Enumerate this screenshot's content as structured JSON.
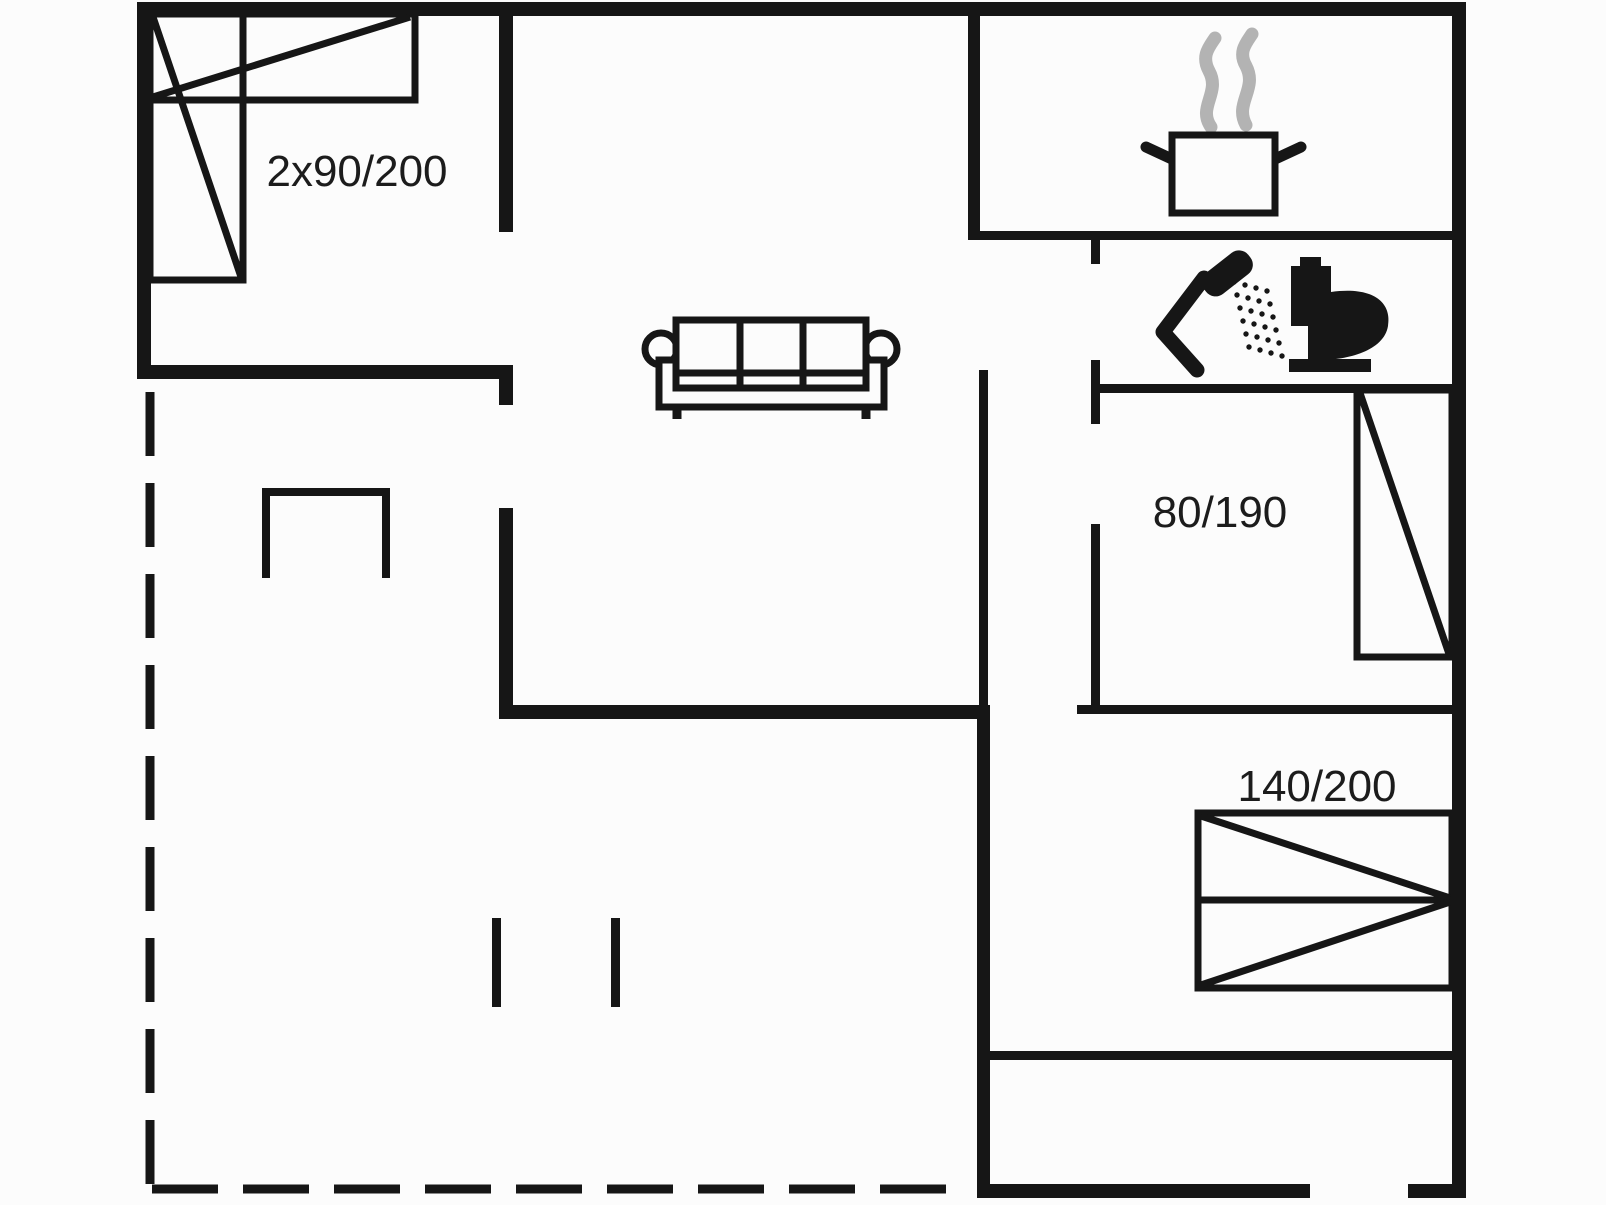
{
  "floorplan": {
    "canvas": {
      "width": 1606,
      "height": 1205,
      "colors": {
        "bg": "#fcfcfc",
        "ink": "#161616",
        "steam": "#b3b3b3",
        "label": "#1c1c1c"
      }
    },
    "labels": [
      {
        "id": "double-bed-size",
        "text": "2x90/200"
      },
      {
        "id": "single-bed-size",
        "text": "80/190"
      },
      {
        "id": "queen-bed-size",
        "text": "140/200"
      }
    ],
    "figures": [
      {
        "name": "terrace-dashed-line-left",
        "tag": "line",
        "attrs": {
          "x1": 150,
          "y1": 392,
          "x2": 150,
          "y2": 1190,
          "stroke": "ink",
          "stroke-width": 9,
          "stroke-dasharray": "64 27"
        }
      },
      {
        "name": "terrace-dashed-line-bottom",
        "tag": "line",
        "attrs": {
          "x1": 152,
          "y1": 1189,
          "x2": 963,
          "y2": 1189,
          "stroke": "ink",
          "stroke-width": 9,
          "stroke-dasharray": "66 25"
        }
      },
      {
        "name": "wall-kitchen-bath-divider",
        "tag": "rect",
        "attrs": {
          "x": 968,
          "y": 231,
          "width": 484,
          "height": 9,
          "fill": "ink"
        }
      },
      {
        "name": "wall-bath-left-stub",
        "tag": "rect",
        "attrs": {
          "x": 1091,
          "y": 240,
          "width": 9,
          "height": 24,
          "fill": "ink"
        }
      },
      {
        "name": "wall-bath-left",
        "tag": "rect",
        "attrs": {
          "x": 1091,
          "y": 360,
          "width": 9,
          "height": 64,
          "fill": "ink"
        }
      },
      {
        "name": "wall-bath-bottom",
        "tag": "rect",
        "attrs": {
          "x": 1091,
          "y": 384,
          "width": 361,
          "height": 9,
          "fill": "ink"
        }
      },
      {
        "name": "wall-bedroom2-left",
        "tag": "rect",
        "attrs": {
          "x": 1091,
          "y": 524,
          "width": 9,
          "height": 188,
          "fill": "ink"
        }
      },
      {
        "name": "wall-bedroom2-bottom",
        "tag": "rect",
        "attrs": {
          "x": 1077,
          "y": 705,
          "width": 375,
          "height": 9,
          "fill": "ink"
        }
      },
      {
        "name": "wall-center-thin",
        "tag": "rect",
        "attrs": {
          "x": 979,
          "y": 370,
          "width": 9,
          "height": 342,
          "fill": "ink"
        }
      },
      {
        "name": "wall-bedroom3-bottom",
        "tag": "rect",
        "attrs": {
          "x": 990,
          "y": 1051,
          "width": 462,
          "height": 9,
          "fill": "ink"
        }
      },
      {
        "name": "wall-stub-hall-a",
        "tag": "rect",
        "attrs": {
          "x": 492,
          "y": 918,
          "width": 9,
          "height": 89,
          "fill": "ink"
        }
      },
      {
        "name": "wall-stub-hall-b",
        "tag": "rect",
        "attrs": {
          "x": 611,
          "y": 918,
          "width": 9,
          "height": 89,
          "fill": "ink"
        }
      },
      {
        "name": "wall-outer-top",
        "tag": "rect",
        "attrs": {
          "x": 137,
          "y": 2,
          "width": 1329,
          "height": 14,
          "fill": "ink"
        }
      },
      {
        "name": "wall-outer-left",
        "tag": "rect",
        "attrs": {
          "x": 137,
          "y": 2,
          "width": 14,
          "height": 377,
          "fill": "ink"
        }
      },
      {
        "name": "wall-outer-right",
        "tag": "rect",
        "attrs": {
          "x": 1452,
          "y": 2,
          "width": 14,
          "height": 1196,
          "fill": "ink"
        }
      },
      {
        "name": "wall-outer-bottom-west",
        "tag": "rect",
        "attrs": {
          "x": 977,
          "y": 1184,
          "width": 333,
          "height": 14,
          "fill": "ink"
        }
      },
      {
        "name": "wall-outer-bottom-east",
        "tag": "rect",
        "attrs": {
          "x": 1408,
          "y": 1184,
          "width": 58,
          "height": 14,
          "fill": "ink"
        }
      },
      {
        "name": "wall-bedroom1-bottom",
        "tag": "rect",
        "attrs": {
          "x": 137,
          "y": 365,
          "width": 376,
          "height": 14,
          "fill": "ink"
        }
      },
      {
        "name": "wall-bedroom1-bottom-stub",
        "tag": "rect",
        "attrs": {
          "x": 499,
          "y": 365,
          "width": 14,
          "height": 40,
          "fill": "ink"
        }
      },
      {
        "name": "wall-bedroom1-right",
        "tag": "rect",
        "attrs": {
          "x": 499,
          "y": 2,
          "width": 14,
          "height": 230,
          "fill": "ink"
        }
      },
      {
        "name": "wall-hall-left",
        "tag": "rect",
        "attrs": {
          "x": 499,
          "y": 508,
          "width": 14,
          "height": 211,
          "fill": "ink"
        }
      },
      {
        "name": "wall-living-bottom",
        "tag": "rect",
        "attrs": {
          "x": 499,
          "y": 705,
          "width": 491,
          "height": 14,
          "fill": "ink"
        }
      },
      {
        "name": "wall-center-lower",
        "tag": "rect",
        "attrs": {
          "x": 977,
          "y": 712,
          "width": 13,
          "height": 486,
          "fill": "ink"
        }
      },
      {
        "name": "wall-kitchen-left",
        "tag": "rect",
        "attrs": {
          "x": 968,
          "y": 10,
          "width": 12,
          "height": 230,
          "fill": "ink"
        }
      },
      {
        "name": "stove-nook-outline",
        "tag": "polyline",
        "attrs": {
          "points": "266,578 266,492 386,492 386,578",
          "fill": "none",
          "stroke": "ink",
          "stroke-width": 8
        }
      },
      {
        "name": "bed-double-rect-horizontal",
        "tag": "rect",
        "attrs": {
          "x": 150,
          "y": 14,
          "width": 265,
          "height": 86,
          "fill": "none",
          "stroke": "ink",
          "stroke-width": 7
        }
      },
      {
        "name": "bed-double-rect-vertical",
        "tag": "rect",
        "attrs": {
          "x": 150,
          "y": 14,
          "width": 93,
          "height": 266,
          "fill": "none",
          "stroke": "ink",
          "stroke-width": 7
        }
      },
      {
        "name": "bed-double-diagonal-h",
        "tag": "line",
        "attrs": {
          "x1": 153,
          "y1": 97,
          "x2": 410,
          "y2": 17,
          "stroke": "ink",
          "stroke-width": 7
        }
      },
      {
        "name": "bed-double-diagonal-v",
        "tag": "line",
        "attrs": {
          "x1": 153,
          "y1": 17,
          "x2": 241,
          "y2": 277,
          "stroke": "ink",
          "stroke-width": 7
        }
      },
      {
        "name": "bed-single-rect",
        "tag": "rect",
        "attrs": {
          "x": 1357,
          "y": 390,
          "width": 95,
          "height": 267,
          "fill": "none",
          "stroke": "ink",
          "stroke-width": 7
        }
      },
      {
        "name": "bed-single-diagonal",
        "tag": "line",
        "attrs": {
          "x1": 1360,
          "y1": 393,
          "x2": 1449,
          "y2": 654,
          "stroke": "ink",
          "stroke-width": 7
        }
      },
      {
        "name": "bed-queen-rect",
        "tag": "rect",
        "attrs": {
          "x": 1198,
          "y": 813,
          "width": 254,
          "height": 175,
          "fill": "none",
          "stroke": "ink",
          "stroke-width": 7
        }
      },
      {
        "name": "bed-queen-midline",
        "tag": "line",
        "attrs": {
          "x1": 1198,
          "y1": 900,
          "x2": 1452,
          "y2": 900,
          "stroke": "ink",
          "stroke-width": 7
        }
      },
      {
        "name": "bed-queen-diagonal-top",
        "tag": "line",
        "attrs": {
          "x1": 1201,
          "y1": 816,
          "x2": 1450,
          "y2": 898,
          "stroke": "ink",
          "stroke-width": 7
        }
      },
      {
        "name": "bed-queen-diagonal-bottom",
        "tag": "line",
        "attrs": {
          "x1": 1201,
          "y1": 985,
          "x2": 1450,
          "y2": 902,
          "stroke": "ink",
          "stroke-width": 7
        }
      },
      {
        "name": "sofa-arm-left",
        "tag": "circle",
        "attrs": {
          "cx": 661,
          "cy": 349,
          "r": 16,
          "fill": "bg",
          "stroke": "ink",
          "stroke-width": 7
        }
      },
      {
        "name": "sofa-arm-right",
        "tag": "circle",
        "attrs": {
          "cx": 881,
          "cy": 349,
          "r": 16,
          "fill": "bg",
          "stroke": "ink",
          "stroke-width": 7
        }
      },
      {
        "name": "sofa-base",
        "tag": "rect",
        "attrs": {
          "x": 659,
          "y": 360,
          "width": 225,
          "height": 47,
          "fill": "bg",
          "stroke": "ink",
          "stroke-width": 7
        }
      },
      {
        "name": "sofa-cushions",
        "tag": "rect",
        "attrs": {
          "x": 676,
          "y": 320,
          "width": 190,
          "height": 68,
          "fill": "bg",
          "stroke": "ink",
          "stroke-width": 7
        }
      },
      {
        "name": "sofa-divider-1",
        "tag": "line",
        "attrs": {
          "x1": 740,
          "y1": 320,
          "x2": 740,
          "y2": 388,
          "stroke": "ink",
          "stroke-width": 7
        }
      },
      {
        "name": "sofa-divider-2",
        "tag": "line",
        "attrs": {
          "x1": 803,
          "y1": 320,
          "x2": 803,
          "y2": 388,
          "stroke": "ink",
          "stroke-width": 7
        }
      },
      {
        "name": "sofa-seat-line",
        "tag": "line",
        "attrs": {
          "x1": 676,
          "y1": 373,
          "x2": 866,
          "y2": 373,
          "stroke": "ink",
          "stroke-width": 7
        }
      },
      {
        "name": "sofa-leg-left",
        "tag": "line",
        "attrs": {
          "x1": 677,
          "y1": 407,
          "x2": 677,
          "y2": 419,
          "stroke": "ink",
          "stroke-width": 9
        }
      },
      {
        "name": "sofa-leg-right",
        "tag": "line",
        "attrs": {
          "x1": 866,
          "y1": 407,
          "x2": 866,
          "y2": 419,
          "stroke": "ink",
          "stroke-width": 9
        }
      },
      {
        "name": "steam-icon-left",
        "tag": "path",
        "attrs": {
          "d": "M 1211 127 C 1197 107 1221 93 1209 71 C 1201 56 1209 47 1215 38",
          "fill": "none",
          "stroke": "steam",
          "stroke-width": 13,
          "stroke-linecap": "round"
        }
      },
      {
        "name": "steam-icon-right",
        "tag": "path",
        "attrs": {
          "d": "M 1246 125 C 1234 103 1258 89 1246 66 C 1238 52 1246 43 1252 34",
          "fill": "none",
          "stroke": "steam",
          "stroke-width": 13,
          "stroke-linecap": "round"
        }
      },
      {
        "name": "pot-handle-left",
        "tag": "line",
        "attrs": {
          "x1": 1146,
          "y1": 147,
          "x2": 1174,
          "y2": 160,
          "stroke": "ink",
          "stroke-width": 11,
          "stroke-linecap": "round"
        }
      },
      {
        "name": "pot-handle-right",
        "tag": "line",
        "attrs": {
          "x1": 1301,
          "y1": 147,
          "x2": 1273,
          "y2": 160,
          "stroke": "ink",
          "stroke-width": 11,
          "stroke-linecap": "round"
        }
      },
      {
        "name": "cooking-pot-icon",
        "tag": "rect",
        "attrs": {
          "x": 1172,
          "y": 135,
          "width": 103,
          "height": 78,
          "fill": "bg",
          "stroke": "ink",
          "stroke-width": 7
        }
      },
      {
        "name": "shower-handle-icon",
        "tag": "polyline",
        "attrs": {
          "points": "1197,370 1163,332 1204,278",
          "fill": "none",
          "stroke": "ink",
          "stroke-width": 15,
          "stroke-linecap": "round",
          "stroke-linejoin": "round"
        }
      },
      {
        "name": "shower-head-icon",
        "tag": "rect",
        "attrs": {
          "x": 1199,
          "y": 260,
          "width": 56,
          "height": 27,
          "rx": 12,
          "fill": "ink",
          "transform": "rotate(-38 1227 273)"
        }
      },
      {
        "name": "shower-spray-dots",
        "tag": "dots",
        "attrs": {
          "r": 2.7,
          "fill": "ink"
        },
        "points": [
          [
            1234,
            282
          ],
          [
            1245,
            285
          ],
          [
            1256,
            288
          ],
          [
            1267,
            291
          ],
          [
            1237,
            295
          ],
          [
            1248,
            298
          ],
          [
            1259,
            301
          ],
          [
            1270,
            304
          ],
          [
            1240,
            308
          ],
          [
            1251,
            311
          ],
          [
            1262,
            314
          ],
          [
            1273,
            317
          ],
          [
            1243,
            321
          ],
          [
            1254,
            324
          ],
          [
            1265,
            327
          ],
          [
            1276,
            330
          ],
          [
            1246,
            334
          ],
          [
            1257,
            337
          ],
          [
            1268,
            340
          ],
          [
            1279,
            343
          ],
          [
            1249,
            347
          ],
          [
            1260,
            350
          ],
          [
            1271,
            353
          ],
          [
            1282,
            356
          ]
        ]
      },
      {
        "name": "toilet-base-icon",
        "tag": "rect",
        "attrs": {
          "x": 1289,
          "y": 359,
          "width": 82,
          "height": 13,
          "fill": "ink"
        }
      },
      {
        "name": "toilet-tank-icon",
        "tag": "rect",
        "attrs": {
          "x": 1291,
          "y": 266,
          "width": 40,
          "height": 60,
          "fill": "ink"
        }
      },
      {
        "name": "toilet-button-icon",
        "tag": "rect",
        "attrs": {
          "x": 1300,
          "y": 257,
          "width": 21,
          "height": 9,
          "fill": "ink"
        }
      },
      {
        "name": "toilet-bowl-icon",
        "tag": "path",
        "attrs": {
          "d": "M 1331 292 C 1374 286 1392 303 1388 326 C 1384 351 1347 360 1320 360 L 1308 360 L 1308 326 L 1331 326 Z",
          "fill": "ink"
        }
      },
      {
        "name": "label-bed-double",
        "tag": "text",
        "attrs": {
          "x": 357,
          "y": 186,
          "font-size": 44,
          "text-anchor": "middle",
          "fill": "label"
        },
        "bind": "floorplan.labels.0.text"
      },
      {
        "name": "label-bed-single",
        "tag": "text",
        "attrs": {
          "x": 1220,
          "y": 527,
          "font-size": 44,
          "text-anchor": "middle",
          "fill": "label"
        },
        "bind": "floorplan.labels.1.text"
      },
      {
        "name": "label-bed-queen",
        "tag": "text",
        "attrs": {
          "x": 1317,
          "y": 801,
          "font-size": 44,
          "text-anchor": "middle",
          "fill": "label"
        },
        "bind": "floorplan.labels.2.text"
      }
    ]
  }
}
